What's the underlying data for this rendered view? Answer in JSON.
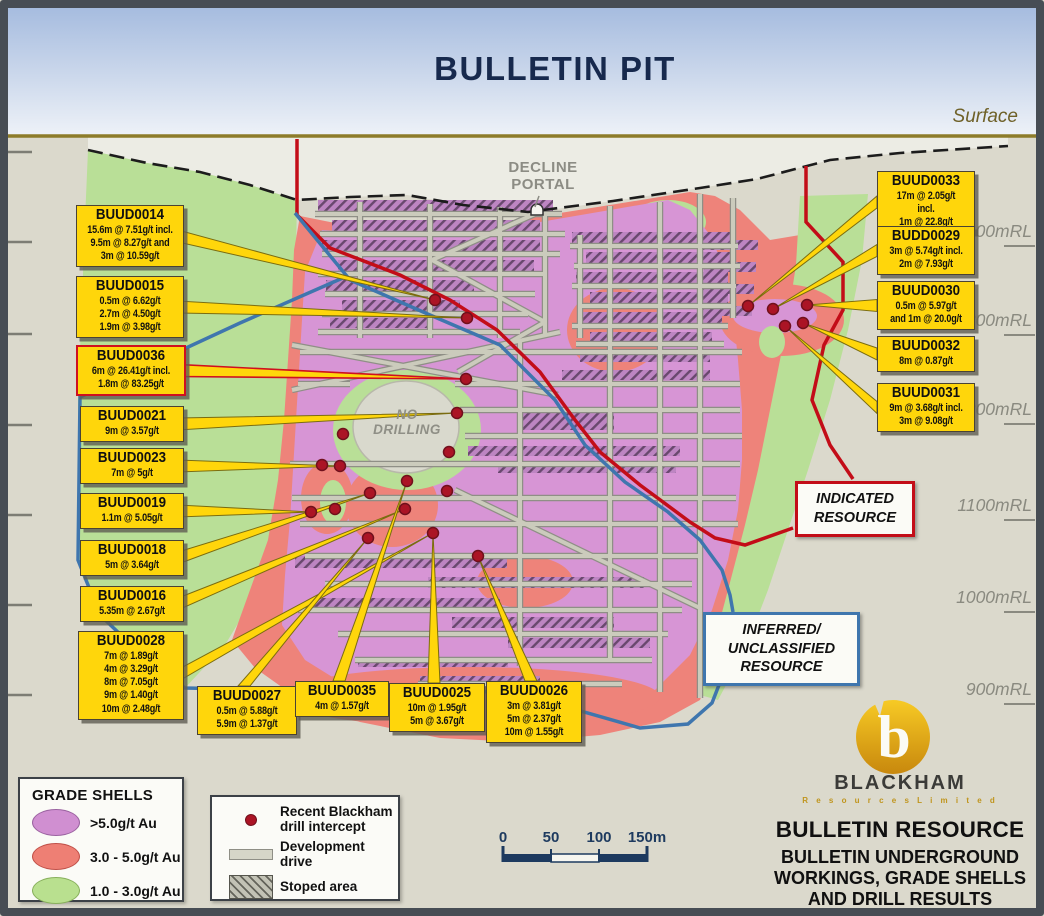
{
  "header": {
    "title": "BULLETIN PIT",
    "surface_label": "Surface"
  },
  "map": {
    "decline_portal_label": "DECLINE\nPORTAL",
    "no_drilling_label": "NO\nDRILLING",
    "elevations": [
      {
        "text": "1400mRL",
        "y": 237
      },
      {
        "text": "1300mRL",
        "y": 326
      },
      {
        "text": "1200mRL",
        "y": 415
      },
      {
        "text": "1100mRL",
        "y": 511
      },
      {
        "text": "1000mRL",
        "y": 603
      },
      {
        "text": "900mRL",
        "y": 695
      }
    ],
    "resource_zones": {
      "indicated": "INDICATED\nRESOURCE",
      "inferred": "INFERRED/\nUNCLASSIFIED\nRESOURCE"
    },
    "drill_dots": [
      [
        435,
        300
      ],
      [
        467,
        318
      ],
      [
        466,
        379
      ],
      [
        457,
        413
      ],
      [
        343,
        434
      ],
      [
        449,
        452
      ],
      [
        322,
        465
      ],
      [
        340,
        466
      ],
      [
        407,
        481
      ],
      [
        370,
        493
      ],
      [
        447,
        491
      ],
      [
        311,
        512
      ],
      [
        335,
        509
      ],
      [
        405,
        509
      ],
      [
        433,
        533
      ],
      [
        368,
        538
      ],
      [
        478,
        556
      ],
      [
        748,
        306
      ],
      [
        773,
        309
      ],
      [
        807,
        305
      ],
      [
        785,
        326
      ],
      [
        803,
        323
      ]
    ]
  },
  "callouts": [
    {
      "id": "BUUD0014",
      "lines": "15.6m @ 7.51g/t incl.\n9.5m @ 8.27g/t and\n3m @ 10.59g/t",
      "x": 76,
      "y": 205,
      "w": 102,
      "side": "right",
      "red": false,
      "target": [
        435,
        300
      ]
    },
    {
      "id": "BUUD0015",
      "lines": "0.5m @ 6.62g/t\n2.7m @ 4.50g/t\n1.9m @ 3.98g/t",
      "x": 76,
      "y": 276,
      "w": 102,
      "side": "right",
      "red": false,
      "target": [
        467,
        318
      ]
    },
    {
      "id": "BUUD0036",
      "lines": "6m @ 26.41g/t incl.\n1.8m @ 83.25g/t",
      "x": 76,
      "y": 345,
      "w": 102,
      "side": "right",
      "red": true,
      "target": [
        466,
        379
      ]
    },
    {
      "id": "BUUD0021",
      "lines": "9m @ 3.57g/t",
      "x": 80,
      "y": 406,
      "w": 98,
      "side": "right",
      "red": false,
      "target": [
        457,
        413
      ]
    },
    {
      "id": "BUUD0023",
      "lines": "7m @ 5g/t",
      "x": 80,
      "y": 448,
      "w": 98,
      "side": "right",
      "red": false,
      "target": [
        340,
        466
      ]
    },
    {
      "id": "BUUD0019",
      "lines": "1.1m @ 5.05g/t",
      "x": 80,
      "y": 493,
      "w": 98,
      "side": "right",
      "red": false,
      "target": [
        311,
        512
      ]
    },
    {
      "id": "BUUD0018",
      "lines": "5m @ 3.64g/t",
      "x": 80,
      "y": 540,
      "w": 98,
      "side": "right",
      "red": false,
      "target": [
        370,
        493
      ]
    },
    {
      "id": "BUUD0016",
      "lines": "5.35m @ 2.67g/t",
      "x": 80,
      "y": 586,
      "w": 98,
      "side": "right",
      "red": false,
      "target": [
        405,
        509
      ]
    },
    {
      "id": "BUUD0028",
      "lines": "7m @ 1.89g/t\n4m @ 3.29g/t\n8m @ 7.05g/t\n9m @ 1.40g/t\n10m @ 2.48g/t",
      "x": 78,
      "y": 631,
      "w": 100,
      "side": "right",
      "red": false,
      "target": [
        433,
        533
      ]
    },
    {
      "id": "BUUD0027",
      "lines": "0.5m @ 5.88g/t\n5.9m @ 1.37g/t",
      "x": 197,
      "y": 686,
      "w": 94,
      "side": "top",
      "red": false,
      "target": [
        368,
        538
      ]
    },
    {
      "id": "BUUD0035",
      "lines": "4m @ 1.57g/t",
      "x": 295,
      "y": 681,
      "w": 88,
      "side": "top",
      "red": false,
      "target": [
        407,
        481
      ]
    },
    {
      "id": "BUUD0025",
      "lines": "10m @ 1.95g/t\n5m @ 3.67g/t",
      "x": 389,
      "y": 683,
      "w": 90,
      "side": "top",
      "red": false,
      "target": [
        433,
        533
      ]
    },
    {
      "id": "BUUD0026",
      "lines": "3m @ 3.81g/t\n5m @ 2.37g/t\n10m @ 1.55g/t",
      "x": 486,
      "y": 681,
      "w": 90,
      "side": "top",
      "red": false,
      "target": [
        478,
        556
      ]
    },
    {
      "id": "BUUD0033",
      "lines": "17m @ 2.05g/t incl.\n1m @ 22.8g/t",
      "x": 877,
      "y": 171,
      "w": 92,
      "side": "left",
      "red": false,
      "target": [
        748,
        306
      ]
    },
    {
      "id": "BUDD0029",
      "lines": "3m @ 5.74g/t incl.\n2m @ 7.93g/t",
      "x": 877,
      "y": 226,
      "w": 92,
      "side": "left",
      "red": false,
      "target": [
        773,
        309
      ]
    },
    {
      "id": "BUUD0030",
      "lines": "0.5m @ 5.97g/t\nand 1m @ 20.0g/t",
      "x": 877,
      "y": 281,
      "w": 92,
      "side": "left",
      "red": false,
      "target": [
        807,
        305
      ]
    },
    {
      "id": "BUUD0032",
      "lines": "8m @ 0.87g/t",
      "x": 877,
      "y": 336,
      "w": 92,
      "side": "left",
      "red": false,
      "target": [
        803,
        323
      ]
    },
    {
      "id": "BUUD0031",
      "lines": "9m @ 3.68g/t incl.\n3m @ 9.08g/t",
      "x": 877,
      "y": 383,
      "w": 92,
      "side": "left",
      "red": false,
      "target": [
        785,
        326
      ]
    }
  ],
  "legend": {
    "shells": {
      "title": "GRADE SHELLS",
      "items": [
        {
          "swatch": "purple-ellipse",
          "label": ">5.0g/t Au"
        },
        {
          "swatch": "pink-ellipse",
          "label": "3.0 - 5.0g/t Au"
        },
        {
          "swatch": "green-ellipse",
          "label": "1.0 - 3.0g/t Au"
        }
      ]
    },
    "symbols": {
      "items": [
        {
          "swatch": "drill-dot",
          "label": "Recent Blackham\ndrill intercept"
        },
        {
          "swatch": "drive-bar",
          "label": "Development\ndrive"
        },
        {
          "swatch": "stoped-area",
          "label": "Stoped area"
        }
      ]
    }
  },
  "scalebar": {
    "labels": [
      "0",
      "50",
      "100",
      "150m"
    ],
    "xs": [
      503,
      551,
      599,
      647
    ]
  },
  "branding": {
    "logo_name": "BLACKHAM",
    "logo_sub": "R e s o u r c e s   L i m i t e d",
    "title": "BULLETIN RESOURCE",
    "subtitle": "BULLETIN UNDERGROUND\nWORKINGS, GRADE SHELLS\nAND DRILL RESULTS"
  },
  "colors": {
    "grade_high_purple": "#d795d5",
    "grade_mid_pink": "#ee837a",
    "grade_low_green": "#b9df97",
    "indicated_red": "#c30d18",
    "inferred_blue": "#3f76ae",
    "callout_yellow": "#ffd60b",
    "drill_dot_red": "#ab1425",
    "title_navy": "#17294d",
    "surface_gold": "#8d7c2a",
    "ground_grey": "#dbd9cc"
  }
}
